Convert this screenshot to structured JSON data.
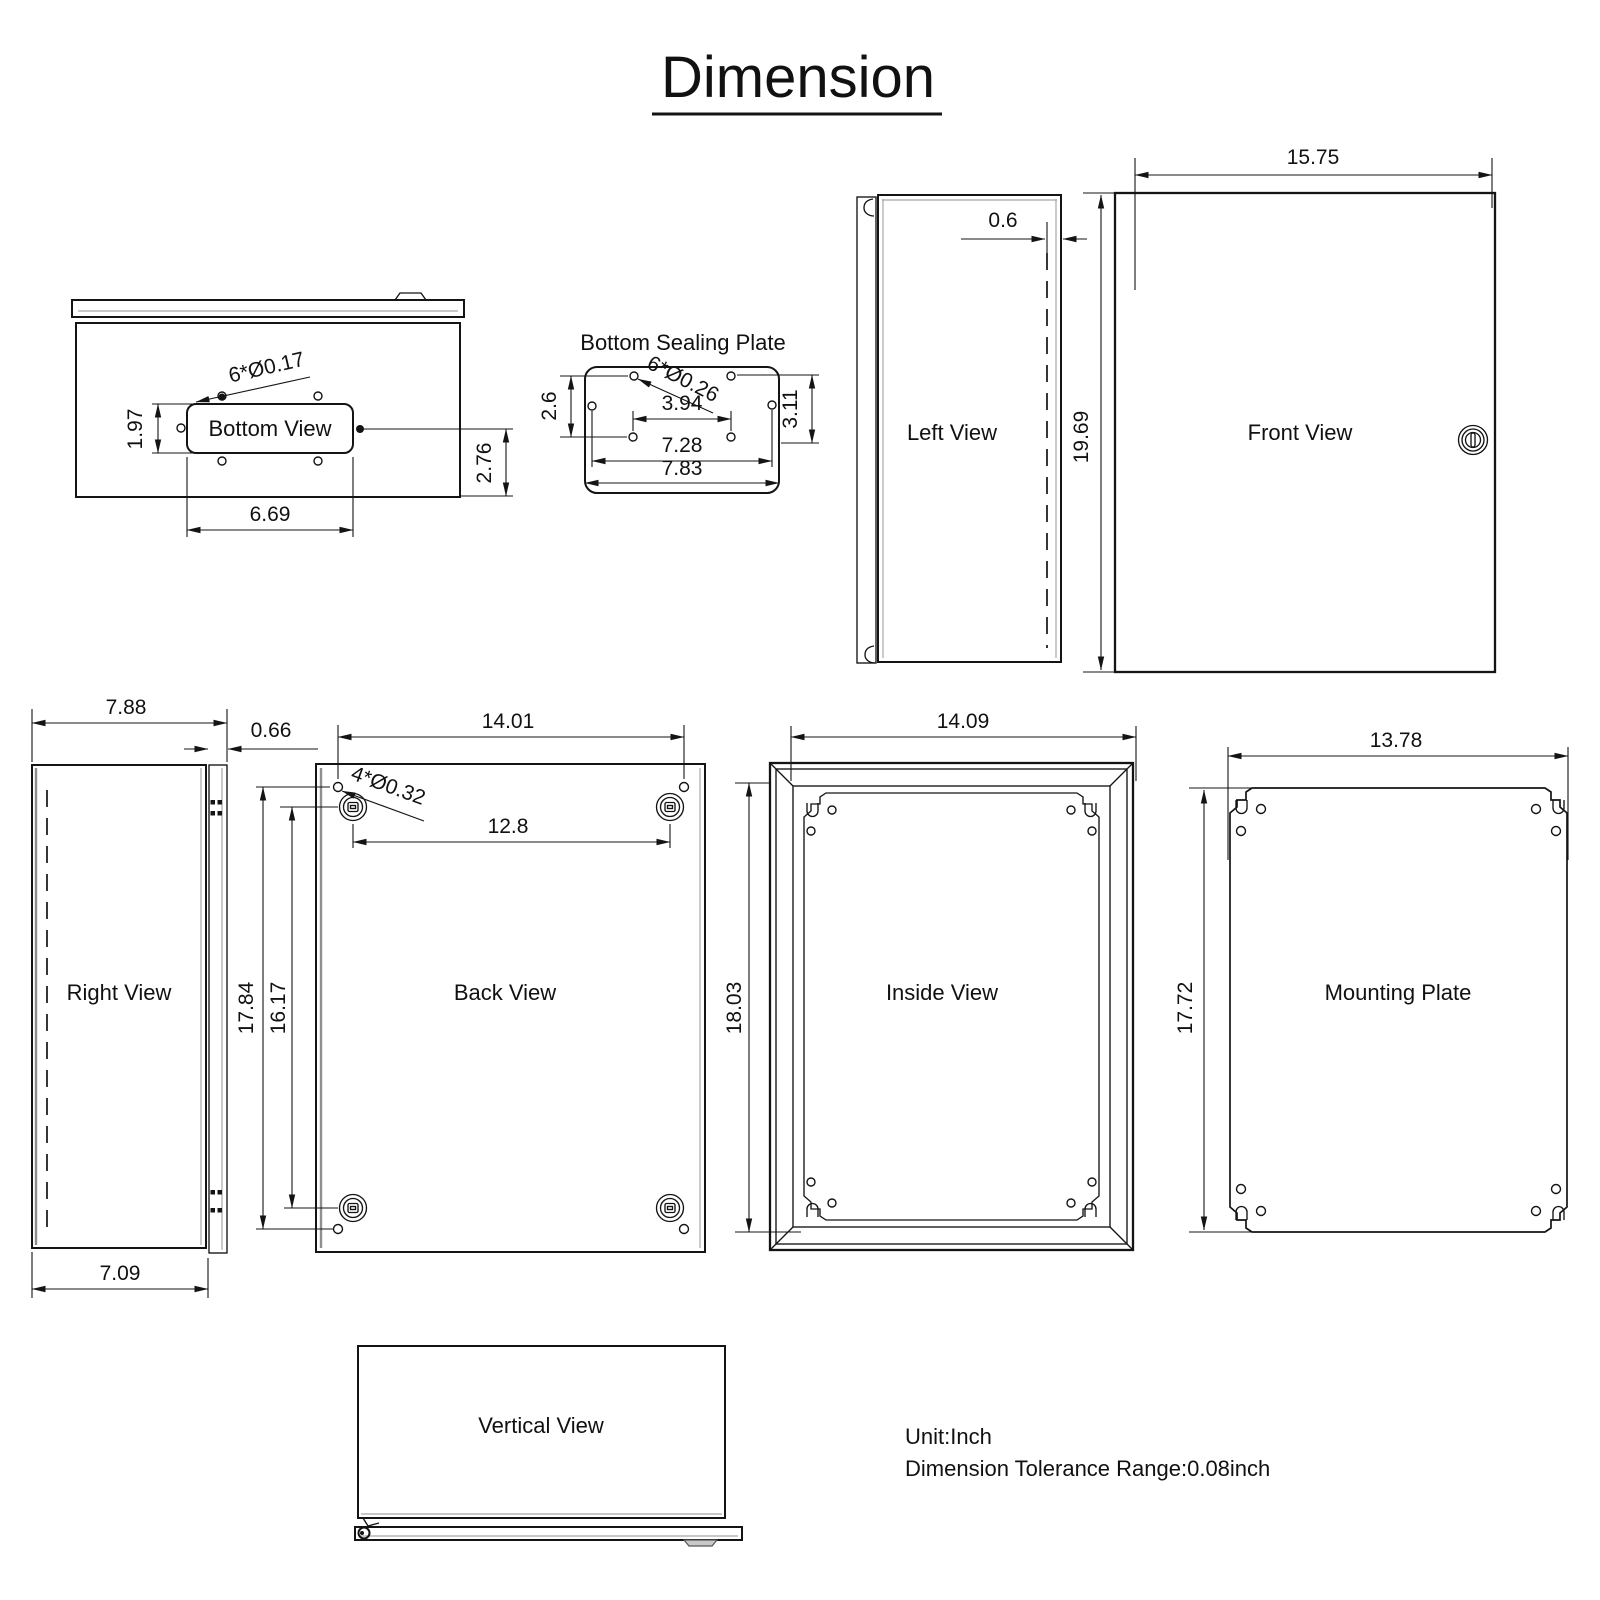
{
  "title": "Dimension",
  "notes": {
    "unit": "Unit:Inch",
    "tolerance": "Dimension Tolerance Range:0.08inch"
  },
  "views": {
    "bottom_view": {
      "label": "Bottom View",
      "dim_holes": "6*Ø0.17",
      "dim_cutout_height": "1.97",
      "dim_side_offset": "2.76",
      "dim_cutout_width": "6.69"
    },
    "sealing_plate": {
      "label": "Bottom Sealing Plate",
      "dim_holes": "6*Ø0.26",
      "dim_hole_rows": "2.6",
      "dim_height": "3.11",
      "dim_hole_span_inner": "3.94",
      "dim_hole_span": "7.28",
      "dim_width": "7.83"
    },
    "left_view": {
      "label": "Left View",
      "dim_door_edge": "0.6"
    },
    "front_view": {
      "label": "Front View",
      "dim_width": "15.75",
      "dim_height": "19.69"
    },
    "right_view": {
      "label": "Right View",
      "dim_depth": "7.88",
      "dim_door_edge": "0.66",
      "dim_body_depth": "7.09"
    },
    "back_view": {
      "label": "Back View",
      "dim_width": "14.01",
      "dim_holes": "4*Ø0.32",
      "dim_hole_span_h": "12.8",
      "dim_hole_span_v": "17.84",
      "dim_boss_span_v": "16.17"
    },
    "inside_view": {
      "label": "Inside View",
      "dim_width": "14.09",
      "dim_height": "18.03"
    },
    "mounting_plate": {
      "label": "Mounting Plate",
      "dim_width": "13.78",
      "dim_height": "17.72"
    },
    "vertical_view": {
      "label": "Vertical View"
    }
  }
}
